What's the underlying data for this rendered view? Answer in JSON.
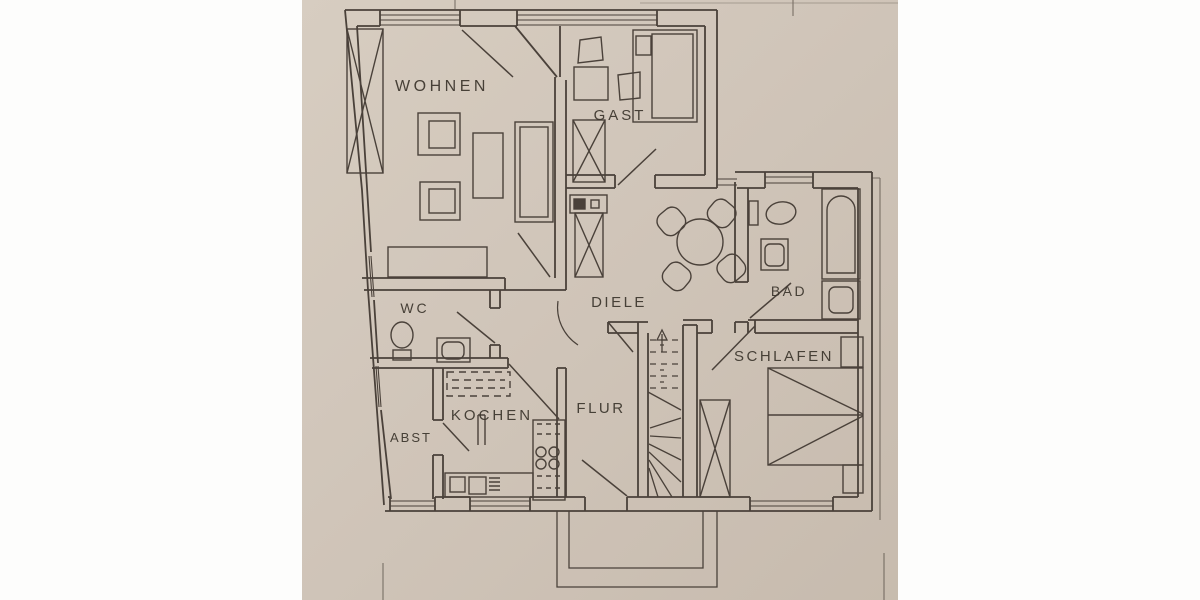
{
  "document": {
    "kind": "apartment floor plan photo",
    "language": "German"
  },
  "floorplan": {
    "rooms": [
      {
        "id": "wohnen",
        "label": "WOHNEN"
      },
      {
        "id": "gast",
        "label": "GAST"
      },
      {
        "id": "wc",
        "label": "WC"
      },
      {
        "id": "diele",
        "label": "DIELE"
      },
      {
        "id": "bad",
        "label": "BAD"
      },
      {
        "id": "kochen",
        "label": "KOCHEN"
      },
      {
        "id": "flur",
        "label": "FLUR"
      },
      {
        "id": "abst",
        "label": "ABST"
      },
      {
        "id": "schlafen",
        "label": "SCHLAFEN"
      }
    ],
    "symbols": [
      "stair-icon",
      "bed-icon",
      "double-bed-icon",
      "wardrobe-icon",
      "sofa-icon",
      "armchair-icon",
      "round-table-icon",
      "chair-icon",
      "toilet-icon",
      "sink-icon",
      "bathtub-icon",
      "stove-icon",
      "kitchen-counter-icon",
      "door-swing-icon",
      "window-icon",
      "chimney-flue-icon",
      "up-arrow-icon"
    ],
    "colors": {
      "paper": "#d4cabd",
      "paper_light": "#dbd2c6",
      "paper_dark": "#cbc0b2",
      "ink": "#4a423a",
      "text": "#3b352c",
      "margin": "#fdfdfc"
    }
  }
}
